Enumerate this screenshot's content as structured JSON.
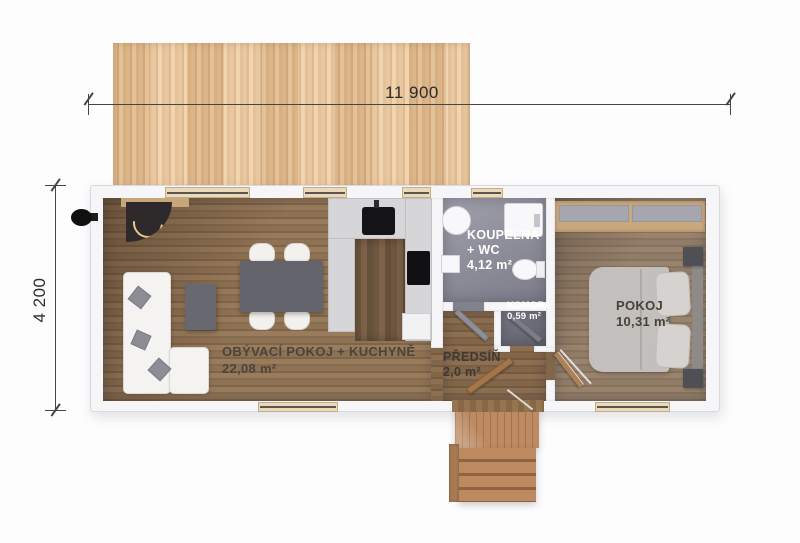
{
  "plan_title": "house floor plan",
  "dimensions": {
    "top": {
      "label": "11 900"
    },
    "left": {
      "label": "4 200"
    }
  },
  "rooms": {
    "living": {
      "name": "OBÝVACÍ POKOJ + KUCHYNĚ",
      "area": "22,08 m²"
    },
    "bathroom": {
      "name": "KOUPELNA + WC",
      "area": "4,12 m²"
    },
    "pantry": {
      "name": "KOMORA",
      "area": "0,59 m²"
    },
    "hallway": {
      "name": "PŘEDSÍŇ",
      "area": "2,0 m²"
    },
    "bedroom": {
      "name": "POKOJ",
      "area": "10,31 m²"
    }
  },
  "furniture": [
    "terrace-deck",
    "fireplace",
    "chimney-vent",
    "corner-sofa",
    "sofa-pillows",
    "coffee-table",
    "dining-table",
    "dining-chairs",
    "kitchen-counter",
    "kitchen-sink",
    "cooktop",
    "dishwasher",
    "shower",
    "bathtub",
    "toilet",
    "washbasin",
    "wardrobe",
    "double-bed",
    "bed-pillows",
    "nightstands",
    "interior-doors",
    "windows",
    "entry-porch-steps"
  ],
  "colors": {
    "deck_wood": "#e2ba8c",
    "floor_wood": "#8a6e50",
    "bathroom_floor": "#8a8a96",
    "pantry_floor": "#70707c",
    "wall_white": "#f6f6f8",
    "dimension_line": "#454545",
    "label_dark": "#4b443c",
    "label_light": "#ffffff",
    "porch_wood": "#b5825c"
  }
}
